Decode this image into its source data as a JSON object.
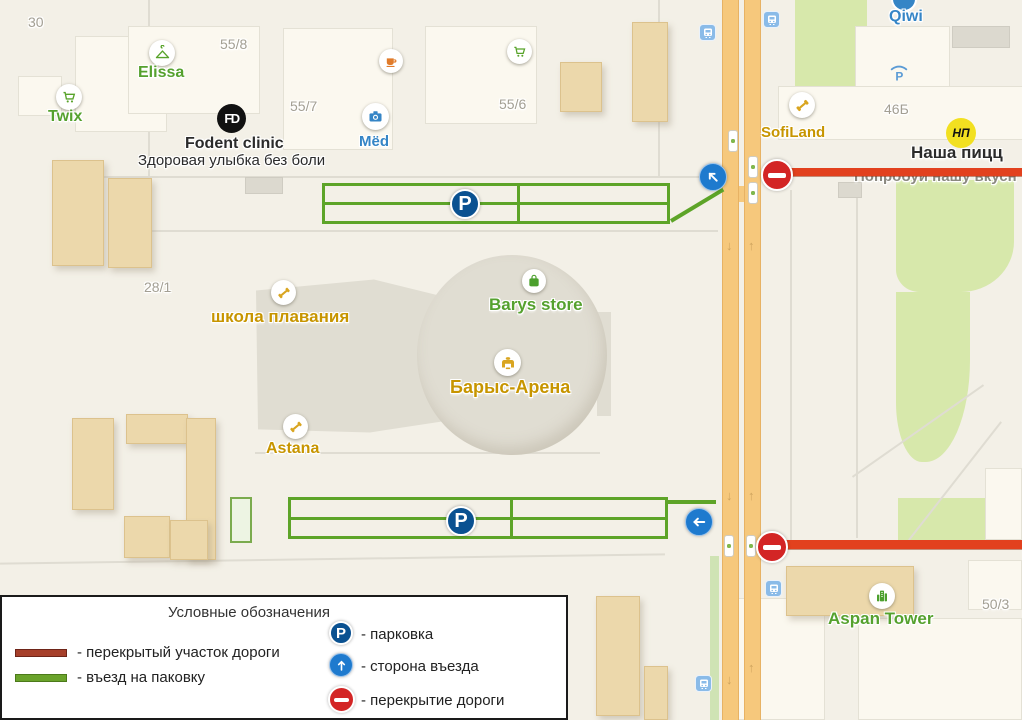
{
  "legend": {
    "title": "Условные обозначения",
    "items": [
      {
        "name": "closed-road-section",
        "label": "- перекрытый участок дороги"
      },
      {
        "name": "parking-entrance",
        "label": "- въезд на паковку"
      },
      {
        "name": "parking",
        "label": "- парковка"
      },
      {
        "name": "entry-side",
        "label": "- сторона въезда"
      },
      {
        "name": "road-closure",
        "label": "- перекрытие дороги"
      }
    ]
  },
  "map": {
    "parking_letter": "P",
    "badges": {
      "fodent": "FD",
      "nasha_pizza": "НП"
    },
    "pois": {
      "twix": "Twix",
      "elissa": "Elissa",
      "fodent": "Fodent clinic",
      "fodent_tagline": "Здоровая улыбка без боли",
      "med": "Mëd",
      "qiwi": "Qiwi",
      "sofiland": "SofiLand",
      "nasha_pizza": "Наша пицц",
      "nasha_pizza_tagline": "Попробуй нашу вкусн",
      "swim_school": "школа плавания",
      "barys_store": "Barys store",
      "barys_arena": "Барыс-Арена",
      "astana": "Astana",
      "aspan_tower": "Aspan Tower"
    },
    "addresses": {
      "n30": "30",
      "n55_8": "55/8",
      "n55_7": "55/7",
      "n55_6": "55/6",
      "n28_1": "28/1",
      "n46b": "46Б",
      "n50_3": "50/3"
    }
  },
  "colors": {
    "closure_red": "#e2411e",
    "entrance_green": "#5da428",
    "parking_blue": "#0a5191",
    "arrow_blue": "#1e7ace",
    "sign_red": "#d32525",
    "road_orange": "#f6c87c",
    "park_green": "#d7e8ab"
  }
}
